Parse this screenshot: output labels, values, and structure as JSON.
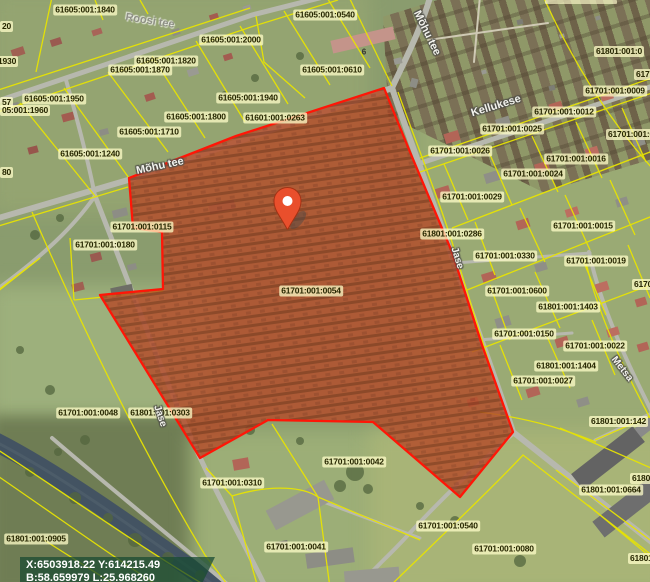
{
  "map_view": {
    "selected_parcel_id": "61701:001:0054",
    "status_overlay": {
      "line1": "X:6503918.22 Y:614215.49",
      "line2": "B:58.659979 L:25.968260"
    },
    "colors": {
      "cadastral_line": "#e8e402",
      "selection_outline": "#ff1607",
      "selection_fill": "#b34f2c",
      "label_background": "rgba(255,253,200,0.75)",
      "marker": "#e94f2c",
      "river": "#435362",
      "road": "#b7b8ae"
    },
    "parcel_labels": [
      {
        "text": "61605:001:1840",
        "x": 85,
        "y": 10
      },
      {
        "text": "61605:001:2000",
        "x": 231,
        "y": 40
      },
      {
        "text": "61605:001:0540",
        "x": 325,
        "y": 15
      },
      {
        "text": "61605:001:1820",
        "x": 166,
        "y": 61
      },
      {
        "text": "61605:001:1870",
        "x": 140,
        "y": 70
      },
      {
        "text": "61605:001:0610",
        "x": 332,
        "y": 70
      },
      {
        "text": "61605:001:1950",
        "x": 54,
        "y": 99
      },
      {
        "text": "61605:001:1940",
        "x": 248,
        "y": 98
      },
      {
        "text": "61605:001:1800",
        "x": 196,
        "y": 117
      },
      {
        "text": "61601:001:0263",
        "x": 275,
        "y": 118
      },
      {
        "text": "61605:001:1710",
        "x": 149,
        "y": 132
      },
      {
        "text": "61605:001:1240",
        "x": 90,
        "y": 154
      },
      {
        "text": "61701:001:0115",
        "x": 142,
        "y": 227
      },
      {
        "text": "61701:001:0180",
        "x": 105,
        "y": 245
      },
      {
        "text": "61701:001:0054",
        "x": 311,
        "y": 291
      },
      {
        "text": "61701:001:0009",
        "x": 615,
        "y": 91
      },
      {
        "text": "61701:001:0012",
        "x": 564,
        "y": 112
      },
      {
        "text": "61701:001:0025",
        "x": 512,
        "y": 129
      },
      {
        "text": "61701:001:0026",
        "x": 460,
        "y": 151
      },
      {
        "text": "61701:001:0016",
        "x": 576,
        "y": 159
      },
      {
        "text": "61701:001:0024",
        "x": 533,
        "y": 174
      },
      {
        "text": "61701:001:0029",
        "x": 472,
        "y": 197
      },
      {
        "text": "61701:001:0015",
        "x": 583,
        "y": 226
      },
      {
        "text": "61801:001:0286",
        "x": 452,
        "y": 234
      },
      {
        "text": "61701:001:0330",
        "x": 505,
        "y": 256
      },
      {
        "text": "61701:001:0019",
        "x": 596,
        "y": 261
      },
      {
        "text": "61701:001:0600",
        "x": 517,
        "y": 291
      },
      {
        "text": "61801:001:1403",
        "x": 568,
        "y": 307
      },
      {
        "text": "61701:001:0150",
        "x": 524,
        "y": 334
      },
      {
        "text": "61701:001:0022",
        "x": 595,
        "y": 346
      },
      {
        "text": "61801:001:1404",
        "x": 566,
        "y": 366
      },
      {
        "text": "61701:001:0027",
        "x": 543,
        "y": 381
      },
      {
        "text": "61701:001:0048",
        "x": 88,
        "y": 413
      },
      {
        "text": "61801:001:0303",
        "x": 160,
        "y": 413
      },
      {
        "text": "61701:001:0042",
        "x": 354,
        "y": 462
      },
      {
        "text": "61701:001:0310",
        "x": 232,
        "y": 483
      },
      {
        "text": "61801:001:0664",
        "x": 611,
        "y": 490
      },
      {
        "text": "61701:001:0540",
        "x": 448,
        "y": 526
      },
      {
        "text": "61801:001:0905",
        "x": 36,
        "y": 539
      },
      {
        "text": "61701:001:0041",
        "x": 296,
        "y": 547
      },
      {
        "text": "61701:001:0080",
        "x": 504,
        "y": 549
      },
      {
        "text": "20",
        "x": 0,
        "y": 21,
        "anchor": "left"
      },
      {
        "text": "1930",
        "x": -4,
        "y": 56,
        "anchor": "left"
      },
      {
        "text": "57",
        "x": 0,
        "y": 97,
        "anchor": "left"
      },
      {
        "text": "05:001:1960",
        "x": 0,
        "y": 105,
        "anchor": "left"
      },
      {
        "text": "80",
        "x": 0,
        "y": 167,
        "anchor": "left"
      },
      {
        "text": "61801:001:0",
        "x": 594,
        "y": 46,
        "anchor": "left"
      },
      {
        "text": "617",
        "x": 634,
        "y": 69,
        "anchor": "left"
      },
      {
        "text": "61701:001:00",
        "x": 606,
        "y": 129,
        "anchor": "left"
      },
      {
        "text": "6170",
        "x": 632,
        "y": 279,
        "anchor": "left"
      },
      {
        "text": "61801:001:142",
        "x": 589,
        "y": 416,
        "anchor": "left"
      },
      {
        "text": "6180",
        "x": 630,
        "y": 473,
        "anchor": "left"
      },
      {
        "text": "61801",
        "x": 628,
        "y": 553,
        "anchor": "left"
      }
    ],
    "street_labels": [
      {
        "text": "Roosi tee",
        "x": 150,
        "y": 21,
        "rot": 9,
        "style": "gray"
      },
      {
        "text": "Mõhu tee",
        "x": 427,
        "y": 33,
        "rot": 64,
        "style": "white"
      },
      {
        "text": "Mõhu tee",
        "x": 160,
        "y": 166,
        "rot": -12,
        "style": "white"
      },
      {
        "text": "Kellukese",
        "x": 496,
        "y": 106,
        "rot": -17,
        "style": "white"
      },
      {
        "text": "Jase",
        "x": 457,
        "y": 258,
        "rot": 73,
        "style": "white"
      },
      {
        "text": "Jase",
        "x": 160,
        "y": 416,
        "rot": 72,
        "style": "white"
      },
      {
        "text": "Metsa",
        "x": 622,
        "y": 369,
        "rot": 52,
        "style": "white"
      }
    ],
    "house_numbers": [
      {
        "text": "6",
        "x": 364,
        "y": 52
      }
    ]
  }
}
